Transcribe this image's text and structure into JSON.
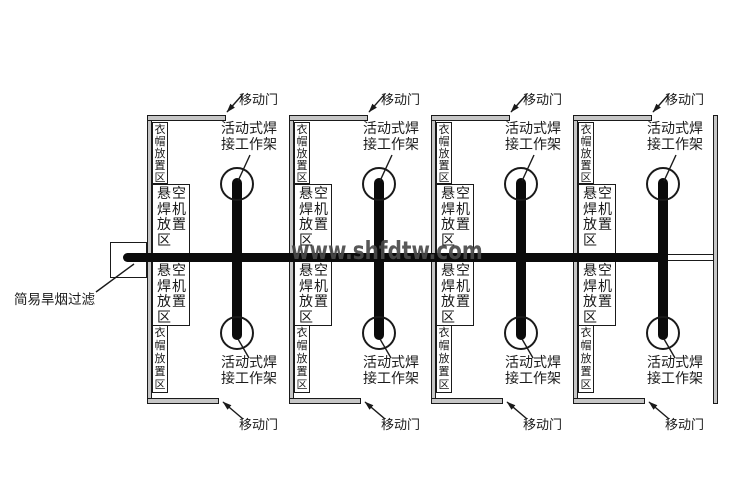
{
  "diagram": {
    "watermark": "www.shfdtw.com",
    "bay_count": 4,
    "labels": {
      "mobile_door": "移动门",
      "work_rack_line1": "活动式焊",
      "work_rack_line2": "接工作架",
      "cloak_area": "衣帽放置区",
      "welder_area": "悬空焊机放置区",
      "smoke_filter": "简易旱烟过滤"
    },
    "colors": {
      "line": "#1a1a1a",
      "wall_fill": "#c6c6c6",
      "watermark": "#4a4a4a",
      "duct": "#0b0b0b",
      "background": "#ffffff"
    }
  }
}
